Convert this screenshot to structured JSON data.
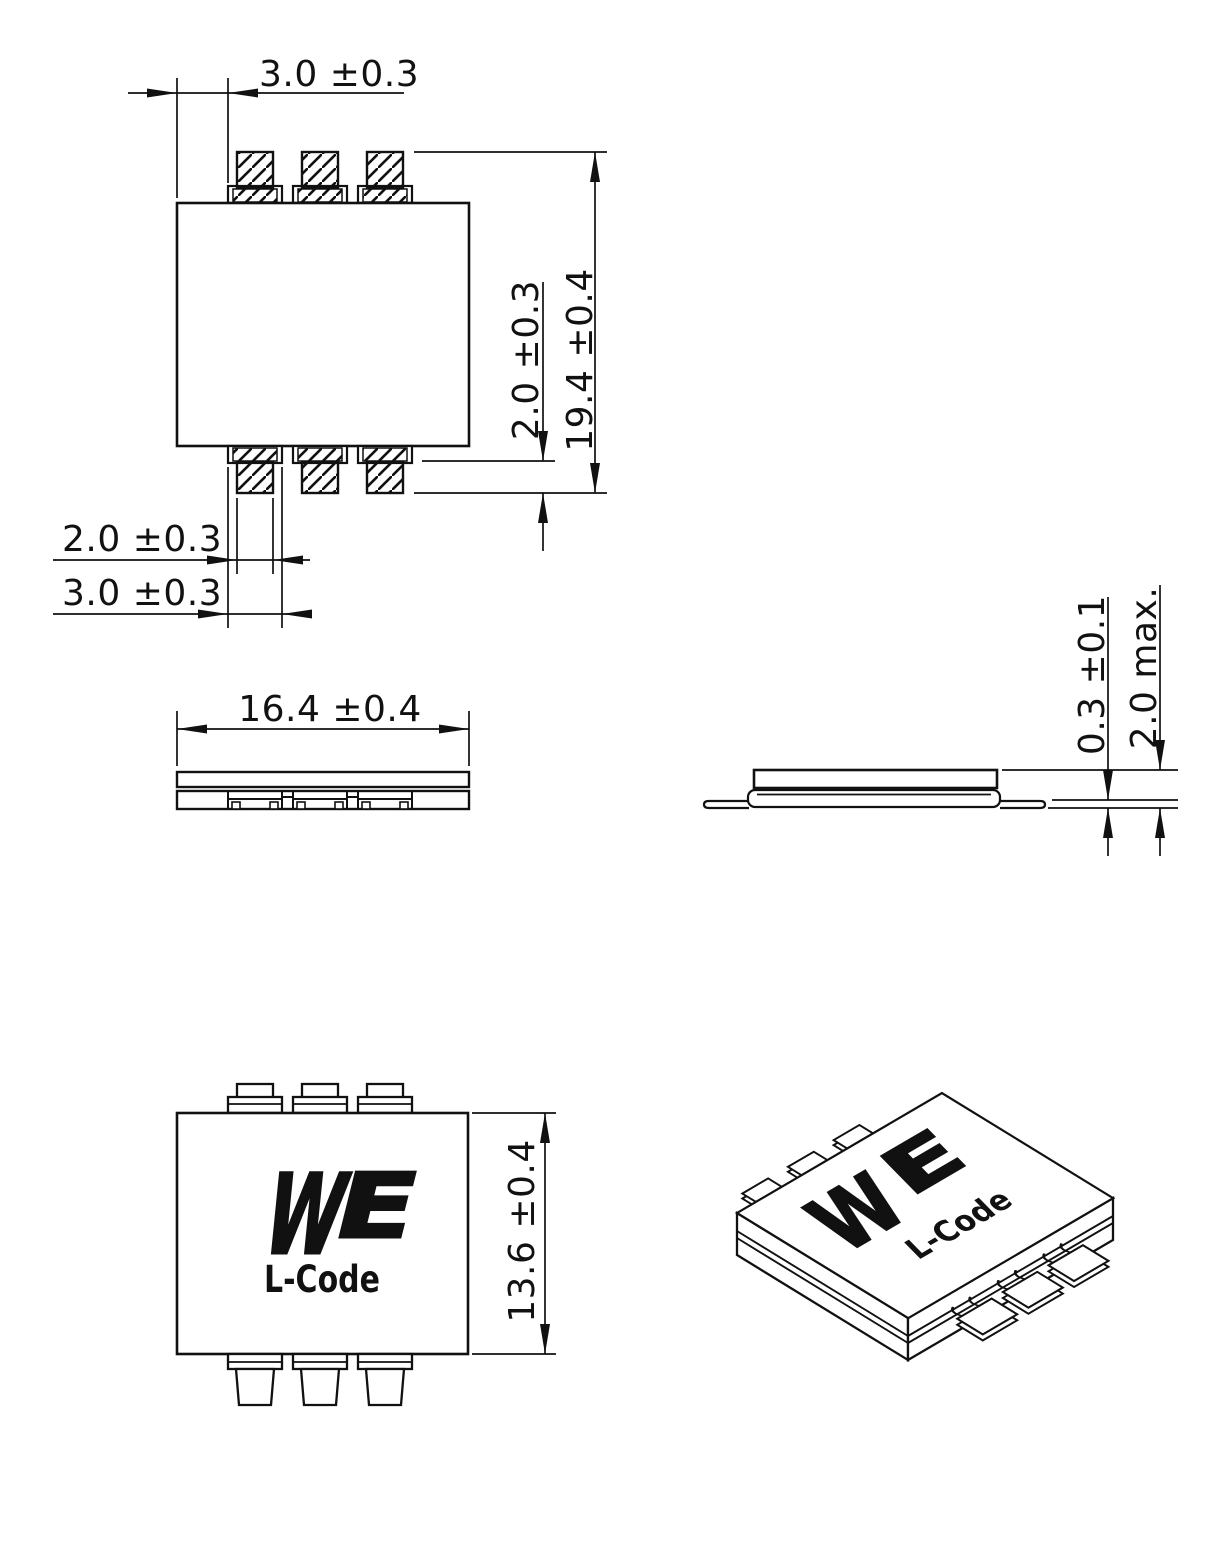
{
  "colors": {
    "line": "#111111",
    "background": "#ffffff"
  },
  "views": {
    "top": {
      "dim_lead_offset": "3.0 ±0.3",
      "dim_overall_length": "19.4 ±0.4",
      "dim_lead_protrusion": "2.0 ±0.3",
      "dim_lead_width": "2.0 ±0.3",
      "dim_lead_base_width": "3.0 ±0.3"
    },
    "front": {
      "dim_body_width": "16.4 ±0.4"
    },
    "profile": {
      "dim_standoff": "0.3 ±0.1",
      "dim_max_height": "2.0 max."
    },
    "bottom": {
      "dim_body_depth": "13.6 ±0.4",
      "logo_w": "W",
      "logo_e": "E",
      "marking": "L-Code"
    },
    "isometric": {
      "logo_w": "W",
      "logo_e": "E",
      "marking": "L-Code"
    }
  }
}
